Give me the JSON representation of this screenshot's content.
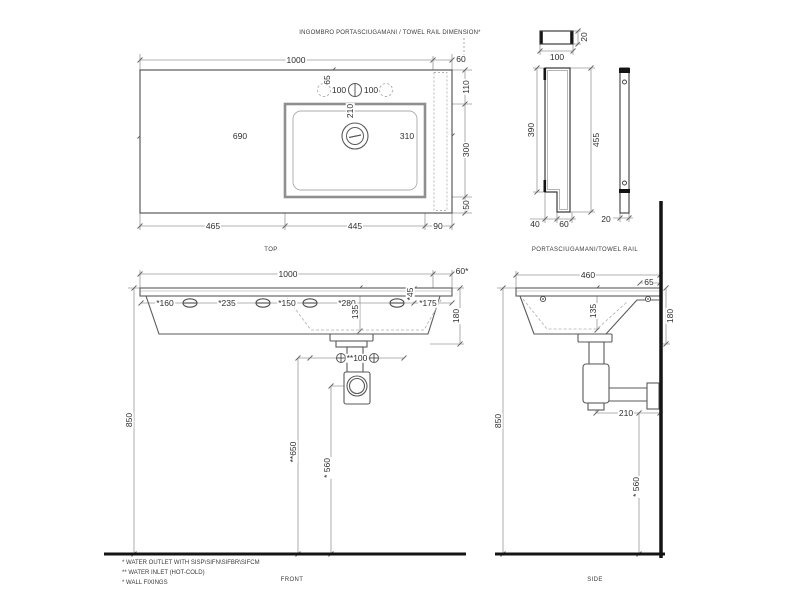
{
  "annotation": {
    "towel_rail_note": "INGOMBRO PORTASCIUGAMANI / TOWEL RAIL DIMENSION*"
  },
  "top_view": {
    "label": "TOP",
    "dim_1000": "1000",
    "dim_60": "60",
    "dim_65": "65",
    "dim_100_left": "100",
    "dim_100_right": "100",
    "dim_210": "210",
    "dim_690": "690",
    "dim_310": "310",
    "dim_110": "110",
    "dim_300": "300",
    "dim_50": "50",
    "dim_465": "465",
    "dim_445": "445",
    "dim_90": "90"
  },
  "towel_rail_view": {
    "label": "PORTASCIUGAMANI/TOWEL RAIL",
    "dim_20_top": "20",
    "dim_100": "100",
    "dim_390": "390",
    "dim_455": "455",
    "dim_40": "40",
    "dim_60": "60",
    "dim_20_side": "20"
  },
  "front_view": {
    "label": "FRONT",
    "dim_1000": "1000",
    "dim_60": "60*",
    "dim_160": "*160",
    "dim_235": "*235",
    "dim_150": "*150",
    "dim_280": "*280",
    "dim_45": "*45",
    "dim_175": "*175",
    "dim_135": "135",
    "dim_180": "180",
    "dim_100": "**100",
    "dim_650": "**650",
    "dim_560": "* 560",
    "dim_850": "850"
  },
  "side_view": {
    "label": "SIDE",
    "dim_460": "460",
    "dim_65": "65",
    "dim_135": "135",
    "dim_180": "180",
    "dim_210": "210",
    "dim_560": "* 560",
    "dim_850": "850"
  },
  "footnotes": [
    "* WATER OUTLET WITH SISP\\SIFN\\SIFBR\\SIFCM",
    "** WATER INLET  (HOT-COLD)",
    "* WALL FIXINGS"
  ],
  "colors": {
    "line": "#5a5a5a",
    "dim_line": "#9a9a9a",
    "dashed": "#b5b5b5",
    "thick": "#141414",
    "text": "#2e2e2e",
    "background": "#ffffff"
  }
}
